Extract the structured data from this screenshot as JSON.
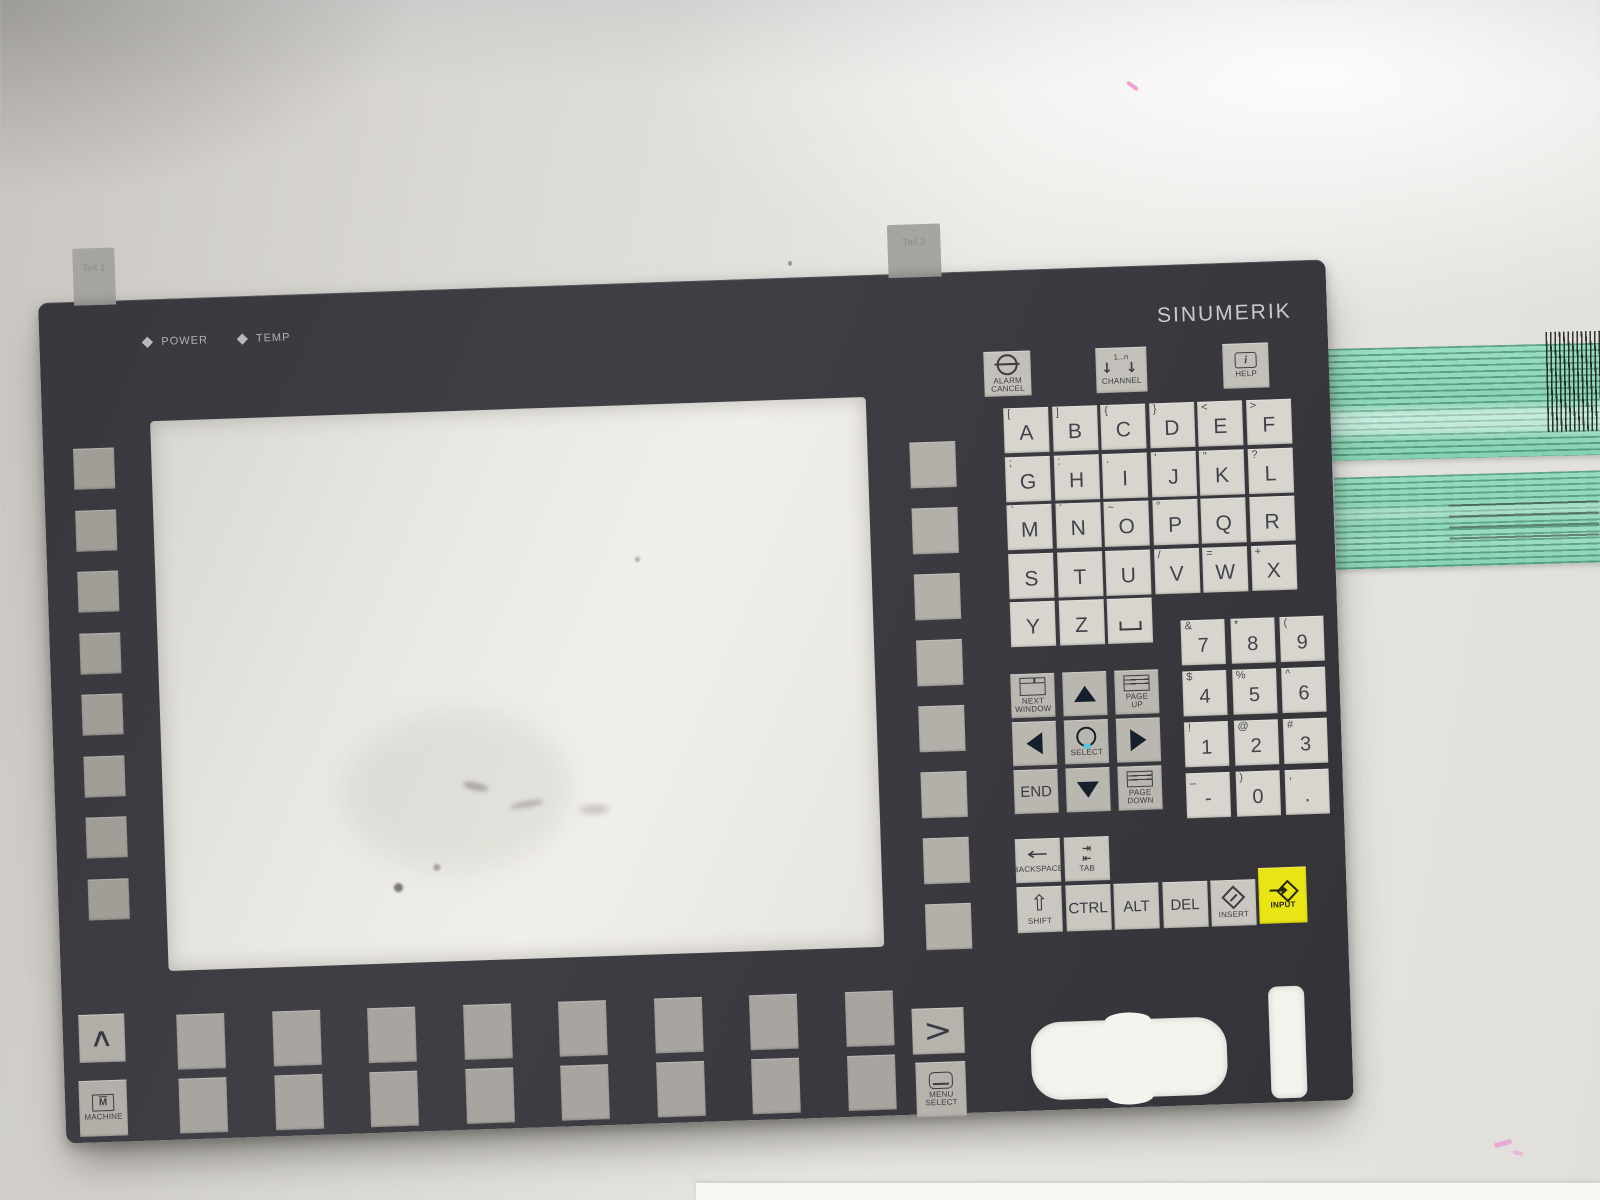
{
  "brand": "SINUMERIK",
  "indicators": [
    {
      "label": "POWER"
    },
    {
      "label": "TEMP"
    }
  ],
  "connector_tabs": [
    {
      "label": "Teil 1"
    },
    {
      "label": "Teil 2"
    }
  ],
  "system_keys": [
    {
      "id": "alarm-cancel",
      "icon": "no-entry-icon",
      "lines": [
        "ALARM",
        "CANCEL"
      ],
      "x": 0,
      "w": 47
    },
    {
      "id": "channel",
      "icon": "double-down-arrow-icon",
      "top": "1...n",
      "lines": [
        "CHANNEL"
      ],
      "x": 112,
      "w": 51
    },
    {
      "id": "help",
      "icon": "info-icon",
      "lines": [
        "HELP"
      ],
      "x": 239,
      "w": 46
    }
  ],
  "alpha_keys": [
    {
      "shift": "[",
      "label": "A"
    },
    {
      "shift": "]",
      "label": "B"
    },
    {
      "shift": "{",
      "label": "C"
    },
    {
      "shift": "}",
      "label": "D"
    },
    {
      "shift": "<",
      "label": "E"
    },
    {
      "shift": ">",
      "label": "F"
    },
    {
      "shift": ";",
      "label": "G"
    },
    {
      "shift": ":",
      "label": "H"
    },
    {
      "shift": ".",
      "label": "I"
    },
    {
      "shift": "'",
      "label": "J"
    },
    {
      "shift": "\"",
      "label": "K"
    },
    {
      "shift": "?",
      "label": "L"
    },
    {
      "shift": "`",
      "label": "M"
    },
    {
      "shift": "´",
      "label": "N"
    },
    {
      "shift": "~",
      "label": "O"
    },
    {
      "shift": "°",
      "label": "P"
    },
    {
      "shift": "",
      "label": "Q"
    },
    {
      "shift": "",
      "label": "R"
    },
    {
      "shift": "",
      "label": "S"
    },
    {
      "shift": "",
      "label": "T"
    },
    {
      "shift": "",
      "label": "U"
    },
    {
      "shift": "/",
      "label": "V"
    },
    {
      "shift": "=",
      "label": "W"
    },
    {
      "shift": "+",
      "label": "X"
    },
    {
      "shift": "",
      "label": "Y"
    },
    {
      "shift": "",
      "label": "Z"
    },
    {
      "shift": "",
      "label": "SPACE",
      "space": true
    }
  ],
  "numpad_keys": [
    {
      "shift": "&",
      "label": "7"
    },
    {
      "shift": "*",
      "label": "8"
    },
    {
      "shift": "(",
      "label": "9"
    },
    {
      "shift": "$",
      "label": "4"
    },
    {
      "shift": "%",
      "label": "5"
    },
    {
      "shift": "^",
      "label": "6"
    },
    {
      "shift": "!",
      "label": "1"
    },
    {
      "shift": "@",
      "label": "2"
    },
    {
      "shift": "#",
      "label": "3"
    },
    {
      "shift": "_",
      "label": "-"
    },
    {
      "shift": ")",
      "label": "0"
    },
    {
      "shift": ",",
      "label": "."
    }
  ],
  "nav_keys": [
    {
      "id": "next-window",
      "style": "gray",
      "icon": "window-icon",
      "lines": [
        "NEXT",
        "WINDOW"
      ]
    },
    {
      "id": "cursor-up",
      "style": "blue",
      "icon": "up-triangle-icon",
      "lines": []
    },
    {
      "id": "page-up",
      "style": "gray",
      "icon": "page-icon",
      "lines": [
        "PAGE",
        "UP"
      ]
    },
    {
      "id": "cursor-left",
      "style": "blue",
      "icon": "left-triangle-icon",
      "lines": []
    },
    {
      "id": "select",
      "style": "blue",
      "icon": "circle-icon",
      "lines": [
        "SELECT"
      ]
    },
    {
      "id": "cursor-right",
      "style": "blue",
      "icon": "right-triangle-icon",
      "lines": []
    },
    {
      "id": "end",
      "style": "gray",
      "big": "END",
      "lines": []
    },
    {
      "id": "cursor-down",
      "style": "blue",
      "icon": "down-triangle-icon",
      "lines": []
    },
    {
      "id": "page-down",
      "style": "gray",
      "icon": "page-icon",
      "lines": [
        "PAGE",
        "DOWN"
      ]
    }
  ],
  "edit_row1": [
    {
      "id": "backspace",
      "icon": "backspace-arrow-icon",
      "lines": [
        "BACKSPACE"
      ]
    },
    {
      "id": "tab",
      "icon": "tab-arrows-icon",
      "lines": [
        "TAB"
      ]
    }
  ],
  "edit_row2": [
    {
      "id": "shift",
      "icon": "shift-arrow-icon",
      "lines": [
        "SHIFT"
      ]
    },
    {
      "id": "ctrl",
      "big": "CTRL",
      "lines": []
    },
    {
      "id": "alt",
      "big": "ALT",
      "lines": []
    },
    {
      "id": "del",
      "big": "DEL",
      "lines": []
    },
    {
      "id": "insert",
      "icon": "insert-diamond-icon",
      "lines": [
        "INSERT"
      ]
    }
  ],
  "input_key": {
    "label": "INPUT",
    "icon": "input-arrow-icon"
  },
  "menu_keys": {
    "recall": {
      "glyph": "∧"
    },
    "machine": {
      "icon_letter": "M",
      "label": "MACHINE"
    },
    "menu_extend": {
      "glyph": ">"
    },
    "menu_select": {
      "lines": [
        "MENU",
        "SELECT"
      ]
    }
  },
  "channel_icon_arrows": "↓ ↓",
  "tab_icon_rows": [
    "⇥",
    "⇤"
  ],
  "backspace_glyph": "←",
  "shift_glyph": "⇧",
  "info_glyph": "i",
  "softkeys": {
    "left_count": 8,
    "right_count": 8,
    "bottom_row1_count": 8,
    "bottom_row2_count": 8
  },
  "colors": {
    "panel": "#3b3a40",
    "key_light": "#d7d5cd",
    "key_gray": "#b2afa8",
    "softkey": "#a8a5a0",
    "cursor_blue": "#58c3e3",
    "input_yellow": "#e9e414",
    "cable_green": "#8fd9ba",
    "screen_white": "#eceae5"
  }
}
